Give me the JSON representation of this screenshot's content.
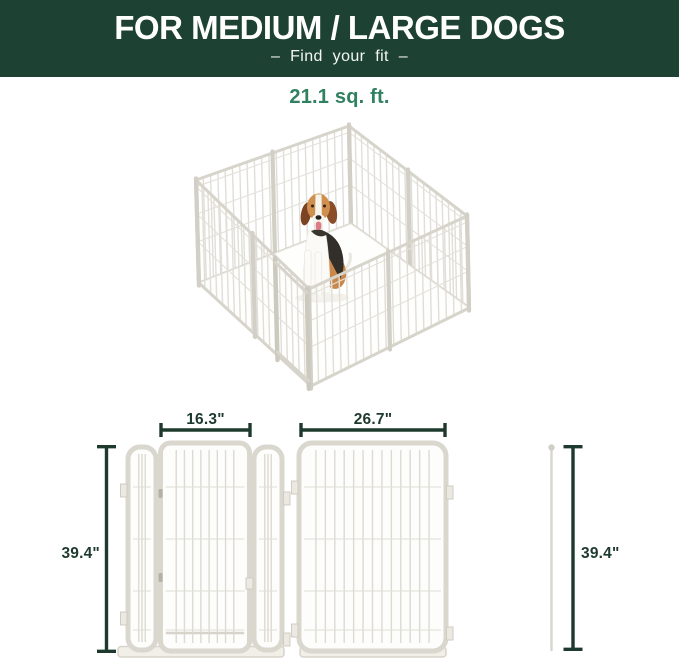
{
  "banner": {
    "title": "FOR MEDIUM / LARGE DOGS",
    "subtitle": "– Find your fit –"
  },
  "area": {
    "label": "21.1 sq. ft."
  },
  "diagram": {
    "door_section": {
      "width": "16.3\"",
      "height": "39.4\""
    },
    "panel": {
      "width": "26.7\""
    },
    "pole": {
      "height": "39.4\""
    }
  },
  "colors": {
    "banner_bg": "#1d4233",
    "banner_text": "#ffffff",
    "accent_green": "#2f8160",
    "dimension_line": "#1e3a2e",
    "panel_stroke": "#d9d7ce",
    "panel_fill": "#fdfdfb"
  }
}
